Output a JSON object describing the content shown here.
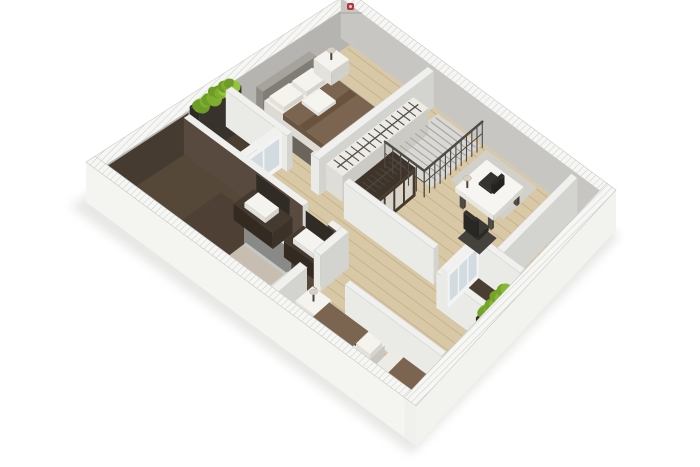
{
  "canvas": {
    "width": 700,
    "height": 467,
    "background": "#ffffff"
  },
  "watermark": {
    "mark_color": "#b23a3b",
    "text_bar_color": "#a9a7a3"
  },
  "palette": {
    "wood_floor": "#d9c8a6",
    "bathroom_floor": "#564839",
    "balcony_floor": "#4a3e31",
    "rug": "#6a645a",
    "wall_white": "#f2f2ef",
    "wall_inner_gray": "#b6b4b0",
    "blanket_brown": "#7b6550",
    "dark_wood": "#3e342a",
    "plant_green": "#86b832",
    "stairs_gray": "#d9d8d4",
    "shadow": "#e3e3e1"
  },
  "projection": {
    "x0": 86,
    "xu": 264,
    "xv": 330,
    "xuv": -64,
    "y0": 202,
    "yu": -170,
    "yv": 244,
    "yuv": -46,
    "ext_wall_h": 40,
    "int_wall_h": 36
  },
  "scene": [
    {
      "type": "shadow",
      "name": "ground-shadow",
      "pts": [
        [
          70,
          206
        ],
        [
          344,
          36
        ],
        [
          620,
          236
        ],
        [
          412,
          454
        ]
      ],
      "fill": "#e3e3e1"
    },
    {
      "type": "quad",
      "name": "wood-floor",
      "rect": [
        0.035,
        0.035,
        0.965,
        0.965
      ],
      "fill": "#d9c8a6"
    },
    {
      "type": "planks",
      "name": "floor-planks",
      "rect": [
        0.05,
        0.04,
        0.95,
        0.96
      ],
      "count": 26,
      "color": "rgba(172,148,110,0.45)",
      "w": 0.9
    },
    {
      "type": "quad",
      "name": "bathroom-floor",
      "rect": [
        0.035,
        0.035,
        0.345,
        0.54
      ],
      "fill": "#564839"
    },
    {
      "type": "quad",
      "name": "bathroom-floor-shade",
      "rect": [
        0.1,
        0.18,
        0.3,
        0.5
      ],
      "fill": "rgba(62,52,42,0.35)"
    },
    {
      "type": "quad",
      "name": "balcony-top-floor",
      "rect": [
        0.352,
        0.035,
        0.512,
        0.21
      ],
      "fill": "#4a3e31"
    },
    {
      "type": "quad",
      "name": "balcony-bottom-floor",
      "rect": [
        0.42,
        0.79,
        0.61,
        0.955
      ],
      "fill": "#4a3e31"
    },
    {
      "type": "quad",
      "name": "stairs-floor",
      "rect": [
        0.74,
        0.37,
        0.955,
        0.53
      ],
      "fill": "#d9d8d4"
    },
    {
      "type": "quad",
      "name": "study-rug",
      "rect": [
        0.8,
        0.55,
        0.955,
        0.74
      ],
      "fill": "#d2d0ca"
    },
    {
      "type": "quad",
      "name": "master-bedroom-rug",
      "rect": [
        0.555,
        0.08,
        0.845,
        0.325
      ],
      "fill": "#6a645a"
    },
    {
      "type": "box",
      "name": "exterior-wall-top-left",
      "rect": [
        0,
        0,
        1,
        0.035
      ],
      "h": 40,
      "hatch": true,
      "left": "#f2f2ef",
      "right": "#b6b4b0",
      "stroke": "#c9c9c5"
    },
    {
      "type": "vface",
      "name": "bathroom-back-wall-dark",
      "from": [
        0.035,
        0.037
      ],
      "to": [
        0.345,
        0.037
      ],
      "z": 0,
      "h": 39,
      "fill": "#463b30"
    },
    {
      "type": "box",
      "name": "exterior-wall-top-right",
      "rect": [
        0.965,
        0,
        1,
        1
      ],
      "h": 40,
      "hatch": true,
      "left": "#c7c6c2",
      "right": "#e9e9e5",
      "stroke": "#c9c9c5"
    },
    {
      "type": "box",
      "name": "balcony-plant-screen",
      "rect": [
        0.352,
        0.035,
        0.512,
        0.068
      ],
      "h": 44,
      "top": "#3a352e",
      "left": "#2f2b26",
      "right": "#37322c"
    },
    {
      "type": "hedge",
      "name": "balcony-top-hedge",
      "from": [
        0.362,
        0.052
      ],
      "to": [
        0.502,
        0.052
      ],
      "z": 40,
      "n": 7,
      "r": 7,
      "colors": [
        "#7fae2e",
        "#92c43c",
        "#6d9d26"
      ]
    },
    {
      "type": "box",
      "name": "bed-headboard",
      "rect": [
        0.595,
        0.045,
        0.8,
        0.068
      ],
      "h": 24,
      "top": "#a6a29c",
      "left": "#8f8b85",
      "right": "#807c76"
    },
    {
      "type": "box",
      "name": "bed-mattress",
      "rect": [
        0.6,
        0.068,
        0.795,
        0.3
      ],
      "h": 14,
      "top": "#f1efe9",
      "left": "#dddbd4",
      "right": "#c8c6bf"
    },
    {
      "type": "box",
      "name": "bed-blanket",
      "rect": [
        0.597,
        0.135,
        0.798,
        0.302
      ],
      "z": 10,
      "h": 6,
      "top": "#7b6550",
      "left": "#6a5543",
      "right": "#5e4b3a"
    },
    {
      "type": "quad",
      "name": "bed-blanket-fold",
      "rect": [
        0.597,
        0.19,
        0.798,
        0.215
      ],
      "z": 16,
      "fill": "#69533f"
    },
    {
      "type": "box",
      "name": "bed-pillow-left",
      "rect": [
        0.612,
        0.075,
        0.688,
        0.125
      ],
      "z": 13,
      "h": 5,
      "top": "#f5f3ed",
      "left": "#e3e1da",
      "right": "#d5d3cc"
    },
    {
      "type": "box",
      "name": "bed-pillow-right",
      "rect": [
        0.7,
        0.075,
        0.776,
        0.125
      ],
      "z": 13,
      "h": 5,
      "top": "#f5f3ed",
      "left": "#e3e1da",
      "right": "#d5d3cc"
    },
    {
      "type": "box",
      "name": "bed-towel",
      "rect": [
        0.662,
        0.142,
        0.732,
        0.2
      ],
      "z": 16,
      "h": 3,
      "top": "#f6f4ef",
      "left": "#e6e4df",
      "right": "#dbd9d4"
    },
    {
      "type": "box",
      "name": "nightstand-master",
      "rect": [
        0.815,
        0.045,
        0.885,
        0.108
      ],
      "h": 14,
      "top": "#f4f3ef",
      "left": "#e4e2dc",
      "right": "#d2d0ca"
    },
    {
      "type": "lamp",
      "name": "lamp-master",
      "at": [
        0.85,
        0.076
      ],
      "z": 14
    },
    {
      "type": "box",
      "name": "bedroom-wall-left-a",
      "rect": [
        0.49,
        0.035,
        0.512,
        0.24
      ],
      "h": 36
    },
    {
      "type": "box",
      "name": "bedroom-wall-left-b",
      "rect": [
        0.49,
        0.32,
        0.512,
        0.347
      ],
      "h": 36
    },
    {
      "type": "box",
      "name": "balcony-glass-door",
      "rect": [
        0.345,
        0.2,
        0.49,
        0.222
      ],
      "h": 36,
      "top": "#f1f1ef",
      "left": "#eaeae7",
      "right": "#f2f3f2",
      "panels": {
        "side": "right",
        "n": 2,
        "color": "rgba(186,203,212,0.6)"
      }
    },
    {
      "type": "box",
      "name": "bathroom-wall-right",
      "rect": [
        0.33,
        0.035,
        0.352,
        0.42
      ],
      "h": 36,
      "top": "#efefed",
      "left": "#584a3e",
      "right": "#d6d6d2"
    },
    {
      "type": "box",
      "name": "bathroom-wall-right-b",
      "rect": [
        0.33,
        0.5,
        0.352,
        0.552
      ],
      "h": 36,
      "top": "#efefed",
      "left": "#584a3e",
      "right": "#d6d6d2"
    },
    {
      "type": "box",
      "name": "toilet",
      "rect": [
        0.048,
        0.115,
        0.118,
        0.185
      ],
      "h": 9,
      "top": "#f2f1ed",
      "left": "#dcdbd6",
      "right": "#cac9c4"
    },
    {
      "type": "box",
      "name": "toilet-tank",
      "rect": [
        0.048,
        0.127,
        0.072,
        0.173
      ],
      "z": 9,
      "h": 10,
      "top": "#eceae6",
      "left": "#d8d6d1",
      "right": "#c6c4bf"
    },
    {
      "type": "box",
      "name": "bidet",
      "rect": [
        0.048,
        0.21,
        0.118,
        0.28
      ],
      "h": 9,
      "top": "#f2f1ed",
      "left": "#dcdbd6",
      "right": "#cac9c4"
    },
    {
      "type": "quad",
      "name": "shower-tray",
      "rect": [
        0.05,
        0.33,
        0.21,
        0.47
      ],
      "z": 1,
      "fill": "#c7bdb0"
    },
    {
      "type": "box",
      "name": "shower-curb",
      "rect": [
        0.05,
        0.462,
        0.21,
        0.472
      ],
      "h": 3,
      "top": "#e8e6e1",
      "left": "#d8d6d1",
      "right": "#c8c6c1"
    },
    {
      "type": "box",
      "name": "shower-glass",
      "rect": [
        0.202,
        0.33,
        0.212,
        0.472
      ],
      "h": 30,
      "top": "#dfe4e6",
      "left": "rgba(196,212,219,0.5)",
      "right": "rgba(186,202,210,0.55)"
    },
    {
      "type": "box",
      "name": "vanity-counter-1",
      "rect": [
        0.25,
        0.26,
        0.332,
        0.385
      ],
      "h": 16,
      "top": "#453a2f",
      "left": "#332b22",
      "right": "#3c3228"
    },
    {
      "type": "vface",
      "name": "vanity-mirror-1",
      "from": [
        0.329,
        0.27
      ],
      "to": [
        0.329,
        0.378
      ],
      "z": 17,
      "h": 17,
      "fill": "#302b25"
    },
    {
      "type": "box",
      "name": "washbasin-1",
      "rect": [
        0.262,
        0.285,
        0.318,
        0.352
      ],
      "z": 16,
      "h": 5,
      "top": "#f4f3ef",
      "left": "#e2e0da",
      "right": "#d4d2cc"
    },
    {
      "type": "box",
      "name": "vanity-counter-2",
      "rect": [
        0.25,
        0.42,
        0.332,
        0.528
      ],
      "h": 16,
      "top": "#453a2f",
      "left": "#332b22",
      "right": "#3c3228"
    },
    {
      "type": "vface",
      "name": "vanity-mirror-2",
      "from": [
        0.329,
        0.43
      ],
      "to": [
        0.329,
        0.52
      ],
      "z": 17,
      "h": 17,
      "fill": "#302b25"
    },
    {
      "type": "box",
      "name": "washbasin-2",
      "rect": [
        0.262,
        0.44,
        0.318,
        0.505
      ],
      "z": 16,
      "h": 5,
      "top": "#f4f3ef",
      "left": "#e2e0da",
      "right": "#d4d2cc"
    },
    {
      "type": "box",
      "name": "hall-wall-bathroom-a",
      "rect": [
        0.035,
        0.53,
        0.17,
        0.552
      ],
      "h": 36
    },
    {
      "type": "box",
      "name": "hall-wall-bathroom-b",
      "rect": [
        0.23,
        0.53,
        0.352,
        0.552
      ],
      "h": 36
    },
    {
      "type": "box",
      "name": "bedroom2-wall-right",
      "rect": [
        0.2,
        0.65,
        0.222,
        0.955
      ],
      "h": 36
    },
    {
      "type": "box",
      "name": "master-wall-lower",
      "rect": [
        0.49,
        0.325,
        0.965,
        0.347
      ],
      "h": 36
    },
    {
      "type": "box",
      "name": "closet-row-top",
      "rect": [
        0.52,
        0.347,
        0.88,
        0.402
      ],
      "h": 26,
      "top": "#edebe6",
      "left": "#dfddd7",
      "right": "#cccac4"
    },
    {
      "type": "ticks",
      "name": "closet-hangers-top",
      "from": [
        0.535,
        0.374
      ],
      "to": [
        0.868,
        0.374
      ],
      "z": 26,
      "n": 14,
      "len": 0.045,
      "color": "#56524b",
      "rail": true
    },
    {
      "type": "box",
      "name": "wardrobe",
      "rect": [
        0.5,
        0.44,
        0.685,
        0.52
      ],
      "h": 28,
      "top": "#3e342a",
      "left": "#32291f",
      "right": "#463a2d",
      "panels": {
        "side": "right",
        "n": 4,
        "color": "#d8d4cc"
      }
    },
    {
      "type": "ticks",
      "name": "wardrobe-hangers",
      "from": [
        0.512,
        0.478
      ],
      "to": [
        0.675,
        0.478
      ],
      "z": 28,
      "n": 9,
      "len": 0.045,
      "color": "#4c463e",
      "rail": true
    },
    {
      "type": "ticks",
      "name": "stair-treads",
      "from": [
        0.757,
        0.452
      ],
      "to": [
        0.948,
        0.452
      ],
      "z": 1,
      "n": 9,
      "len": 0.145,
      "color": "#a8a7a2",
      "w": 1.2
    },
    {
      "type": "railing",
      "name": "stair-railing-long",
      "from": [
        0.7,
        0.538
      ],
      "to": [
        0.953,
        0.538
      ],
      "h": 26,
      "n": 12,
      "color": "#4e4a44"
    },
    {
      "type": "railing",
      "name": "stair-railing-return",
      "from": [
        0.7,
        0.4
      ],
      "to": [
        0.7,
        0.538
      ],
      "h": 26,
      "n": 6,
      "color": "#4e4a44"
    },
    {
      "type": "box",
      "name": "study-wall-left",
      "rect": [
        0.478,
        0.44,
        0.5,
        0.74
      ],
      "h": 36
    },
    {
      "type": "box",
      "name": "study-wall-lower",
      "rect": [
        0.61,
        0.86,
        0.965,
        0.882
      ],
      "h": 36
    },
    {
      "type": "box",
      "name": "balcony2-wall-left",
      "rect": [
        0.42,
        0.79,
        0.442,
        0.955
      ],
      "h": 36
    },
    {
      "type": "box",
      "name": "balcony2-wall-right",
      "rect": [
        0.588,
        0.79,
        0.61,
        0.955
      ],
      "h": 36
    },
    {
      "type": "box",
      "name": "balcony2-glass-door",
      "rect": [
        0.442,
        0.79,
        0.588,
        0.812
      ],
      "h": 36,
      "top": "#f1f1ef",
      "left": "#eaeae7",
      "right": "#f2f3f2",
      "panels": {
        "side": "right",
        "n": 3,
        "color": "rgba(186,203,212,0.6)"
      }
    },
    {
      "type": "box",
      "name": "desk-leg-1",
      "rect": [
        0.745,
        0.627,
        0.757,
        0.639
      ],
      "h": 13,
      "top": "#5a574f",
      "left": "#4e4b44",
      "right": "#45423c"
    },
    {
      "type": "box",
      "name": "desk-leg-2",
      "rect": [
        0.863,
        0.627,
        0.875,
        0.639
      ],
      "h": 13,
      "top": "#5a574f",
      "left": "#4e4b44",
      "right": "#45423c"
    },
    {
      "type": "box",
      "name": "desk-leg-3",
      "rect": [
        0.745,
        0.727,
        0.757,
        0.739
      ],
      "h": 13,
      "top": "#5a574f",
      "left": "#4e4b44",
      "right": "#45423c"
    },
    {
      "type": "box",
      "name": "desk-leg-4",
      "rect": [
        0.863,
        0.727,
        0.875,
        0.739
      ],
      "h": 13,
      "top": "#5a574f",
      "left": "#4e4b44",
      "right": "#45423c"
    },
    {
      "type": "box",
      "name": "desk-top",
      "rect": [
        0.74,
        0.615,
        0.88,
        0.75
      ],
      "z": 13,
      "h": 5,
      "top": "#f6f5f1",
      "left": "#e7e6e1",
      "right": "#d5d4cf"
    },
    {
      "type": "box",
      "name": "laptop-base",
      "rect": [
        0.795,
        0.655,
        0.85,
        0.7
      ],
      "z": 18,
      "h": 2,
      "top": "#35332f",
      "left": "#2b2926",
      "right": "#262522"
    },
    {
      "type": "box",
      "name": "laptop-screen",
      "rect": [
        0.8,
        0.695,
        0.848,
        0.706
      ],
      "z": 18,
      "h": 9,
      "top": "#2e2c29",
      "left": "#262522",
      "right": "#232220"
    },
    {
      "type": "lamp",
      "name": "desk-lamp",
      "at": [
        0.765,
        0.638
      ],
      "z": 18
    },
    {
      "type": "quad",
      "name": "office-chair-base",
      "rect": [
        0.652,
        0.692,
        0.732,
        0.768
      ],
      "z": 1,
      "fill": "#45423d"
    },
    {
      "type": "box",
      "name": "office-chair-seat",
      "rect": [
        0.668,
        0.708,
        0.716,
        0.752
      ],
      "z": 8,
      "h": 5,
      "top": "#3b3935",
      "left": "#312f2c",
      "right": "#2c2a27"
    },
    {
      "type": "box",
      "name": "office-chair-back",
      "rect": [
        0.658,
        0.708,
        0.67,
        0.752
      ],
      "z": 13,
      "h": 16,
      "top": "#33312d",
      "left": "#2a2825",
      "right": "#262420"
    },
    {
      "type": "box",
      "name": "nightstand-bedroom2",
      "rect": [
        0.115,
        0.555,
        0.19,
        0.615
      ],
      "h": 14,
      "top": "#f4f3ef",
      "left": "#e4e2dc",
      "right": "#d2d0ca"
    },
    {
      "type": "lamp",
      "name": "lamp-bedroom2",
      "at": [
        0.152,
        0.585
      ],
      "z": 14
    },
    {
      "type": "box",
      "name": "bed2a-mattress",
      "rect": [
        0.045,
        0.615,
        0.178,
        0.79
      ],
      "h": 13,
      "top": "#f1efe9",
      "left": "#dddbd4",
      "right": "#c8c6bf"
    },
    {
      "type": "box",
      "name": "bed2a-blanket",
      "rect": [
        0.043,
        0.615,
        0.18,
        0.737
      ],
      "z": 9,
      "h": 5,
      "top": "#7b6550",
      "left": "#6a5543",
      "right": "#5e4b3a"
    },
    {
      "type": "box",
      "name": "bed2a-pillow-1",
      "rect": [
        0.052,
        0.742,
        0.108,
        0.786
      ],
      "z": 11,
      "h": 5,
      "top": "#f5f3ed",
      "left": "#e3e1da",
      "right": "#d5d3cc"
    },
    {
      "type": "box",
      "name": "bed2a-pillow-2",
      "rect": [
        0.116,
        0.742,
        0.172,
        0.786
      ],
      "z": 11,
      "h": 5,
      "top": "#f5f3ed",
      "left": "#e3e1da",
      "right": "#d5d3cc"
    },
    {
      "type": "box",
      "name": "bed2b-mattress",
      "rect": [
        0.045,
        0.812,
        0.178,
        0.955
      ],
      "h": 13,
      "top": "#f1efe9",
      "left": "#dddbd4",
      "right": "#c8c6bf"
    },
    {
      "type": "box",
      "name": "bed2b-sheet",
      "rect": [
        0.043,
        0.812,
        0.18,
        0.848
      ],
      "z": 9,
      "h": 5,
      "top": "#ecebe5",
      "left": "#dcdad4",
      "right": "#cfcdc7"
    },
    {
      "type": "box",
      "name": "bed2b-blanket",
      "rect": [
        0.043,
        0.848,
        0.18,
        0.957
      ],
      "z": 9,
      "h": 5,
      "top": "#7b6550",
      "left": "#6a5543",
      "right": "#5e4b3a"
    },
    {
      "type": "box",
      "name": "balcony2-planter",
      "rect": [
        0.45,
        0.9,
        0.585,
        0.948
      ],
      "h": 9,
      "top": "#302b25",
      "left": "#262320",
      "right": "#2b2723"
    },
    {
      "type": "hedge",
      "name": "balcony2-hedge",
      "from": [
        0.46,
        0.922
      ],
      "to": [
        0.575,
        0.922
      ],
      "z": 9,
      "n": 6,
      "r": 8,
      "colors": [
        "#86b832",
        "#97c93e",
        "#74a428"
      ]
    },
    {
      "type": "box",
      "name": "exterior-wall-bottom-left",
      "rect": [
        0,
        0,
        0.035,
        1
      ],
      "h": 40,
      "hatch": true,
      "left": "#f4f4f1",
      "right": "#dbdbd7",
      "stroke": "#c9c9c5"
    },
    {
      "type": "box",
      "name": "exterior-wall-bottom-right",
      "rect": [
        0,
        0.965,
        1,
        1
      ],
      "h": 40,
      "hatch": true,
      "left": "#f0f0ed",
      "right": "#f2f2ef",
      "stroke": "#c9c9c5"
    }
  ]
}
